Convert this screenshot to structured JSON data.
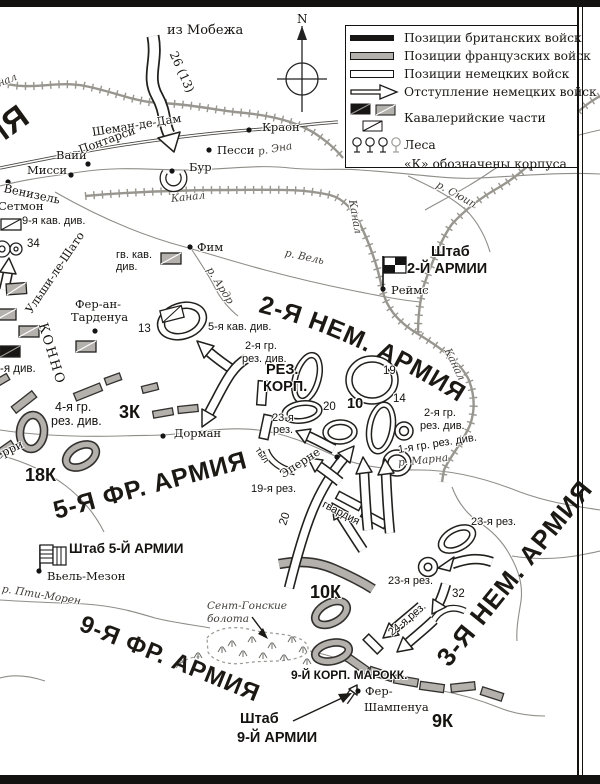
{
  "legend": {
    "items": [
      "Позиции британских войск",
      "Позиции французских войск",
      "Позиции немецких войск",
      "Отступление немецких войск",
      "Кавалерийские части",
      "Леса",
      "«К» обозначены корпуса"
    ]
  },
  "compass": {
    "n": "N"
  },
  "armies": {
    "g2": "2-Я НЕМ. АРМИЯ",
    "g3": "3-Я НЕМ. АРМИЯ",
    "f5": "5-Я ФР. АРМИЯ",
    "f9": "9-Я ФР. АРМИЯ",
    "cut": "ИЯ"
  },
  "hq": {
    "h2a": "Штаб",
    "h2b": "2-Й АРМИИ",
    "h5": "Штаб 5-Й АРМИИ",
    "h9a": "Штаб",
    "h9b": "9-Й АРМИИ"
  },
  "towns": {
    "kraon": "Краон",
    "pessi": "Песси",
    "bur": "Бур",
    "vaji": "Вайи",
    "missi": "Мисси",
    "venizel": "Венизель",
    "setmon": "Сетмон",
    "fim": "Фим",
    "reims": "Реймс",
    "dorman": "Дорман",
    "epernay": "Эперне",
    "vielmaison": "Вьель-Мезон",
    "feran1": "Фер-ан-",
    "feran2": "Тарденуа",
    "fersh1": "Фер-",
    "fersh2": "Шампенуа",
    "erri": "ерри",
    "ulshi": "Ульши-ле-Шато"
  },
  "waters": {
    "kanal1": "нал",
    "kanal2": "Канал",
    "kanal3": "Канал",
    "kanal4": "Канал",
    "ena": "р. Эна",
    "suip": "р. Сюип",
    "vel": "р. Вель",
    "ardr": "р. Ардр",
    "marna": "р. Марна",
    "ptimoren": "р. Пти-Морен"
  },
  "roads": {
    "chemin": "Шеман-де-Дам",
    "pontarsi": "Понтарси"
  },
  "marsh": {
    "l1": "Сент-Гонские",
    "l2": "болота"
  },
  "units": {
    "kav9": "9-я кав. див.",
    "n34": "34",
    "gvkav1": "гв. кав.",
    "gvkav2": "див.",
    "n13": "13",
    "kav5": "5-я кав. див.",
    "gr2l1": "2-я гр.",
    "gr2l2": "рез. див.",
    "rez": "РЕЗ.",
    "korp": "КОРП.",
    "r23a1": "23-я",
    "r23a2": "рез.",
    "n19": "19",
    "n10": "10",
    "n20": "20",
    "n14": "14",
    "gr2r1": "2-я гр.",
    "gr2r2": "рез. див.",
    "gr1": "1-я гр. рез. див.",
    "tyl": "тыл",
    "gr4l1": "4-я гр.",
    "gr4l2": "рез. див.",
    "rez19": "19-я рез.",
    "gvardia": "гвардия",
    "n20b": "20",
    "rez23b": "23-я рез.",
    "n32": "32",
    "rez24": "24-я рез.",
    "rez23c": "23-я рез.",
    "marokk": "9-Й КОРП. МАРОКК.",
    "divx": "-я див.",
    "konno": "КОННО",
    "mobezh": "из Мобежа",
    "n2613": "26 (13)"
  },
  "corps": {
    "k3": "3К",
    "k18": "18К",
    "k10": "10К",
    "k9": "9К"
  }
}
